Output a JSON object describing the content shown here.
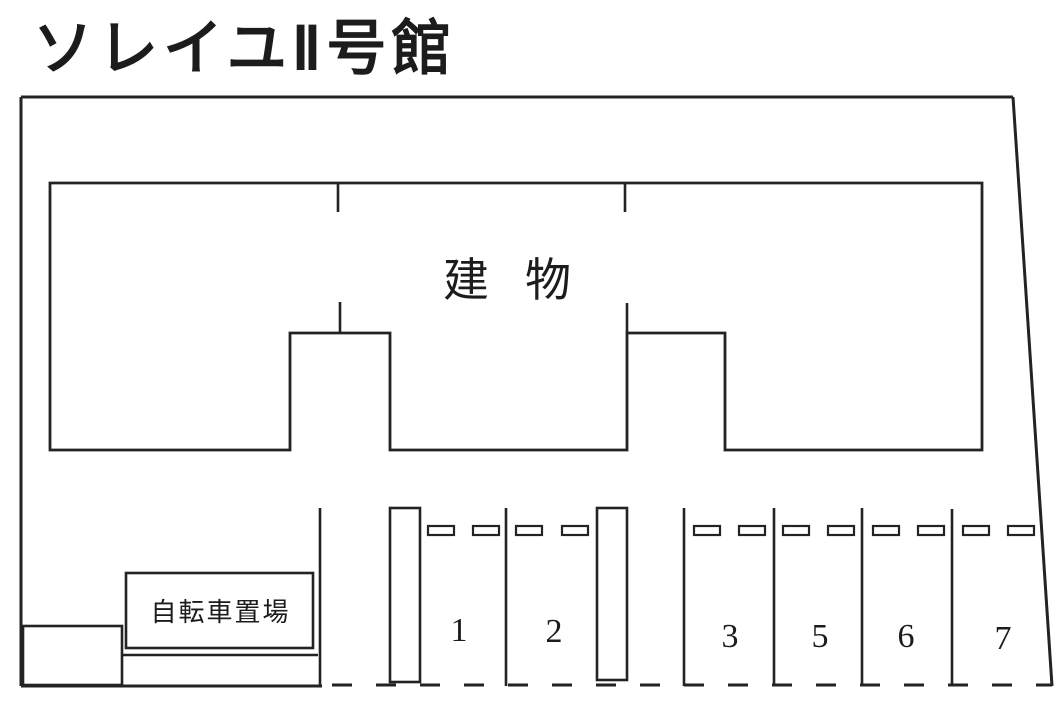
{
  "title": "ソレイユⅡ号館",
  "building": {
    "label": "建物"
  },
  "bicycle_area": {
    "label": "自転車置場"
  },
  "parking": {
    "spaces": [
      {
        "label": "1"
      },
      {
        "label": "2"
      },
      {
        "label": "3"
      },
      {
        "label": "5"
      },
      {
        "label": "6"
      },
      {
        "label": "7"
      }
    ]
  },
  "colors": {
    "line": "#232323",
    "background": "#ffffff"
  }
}
